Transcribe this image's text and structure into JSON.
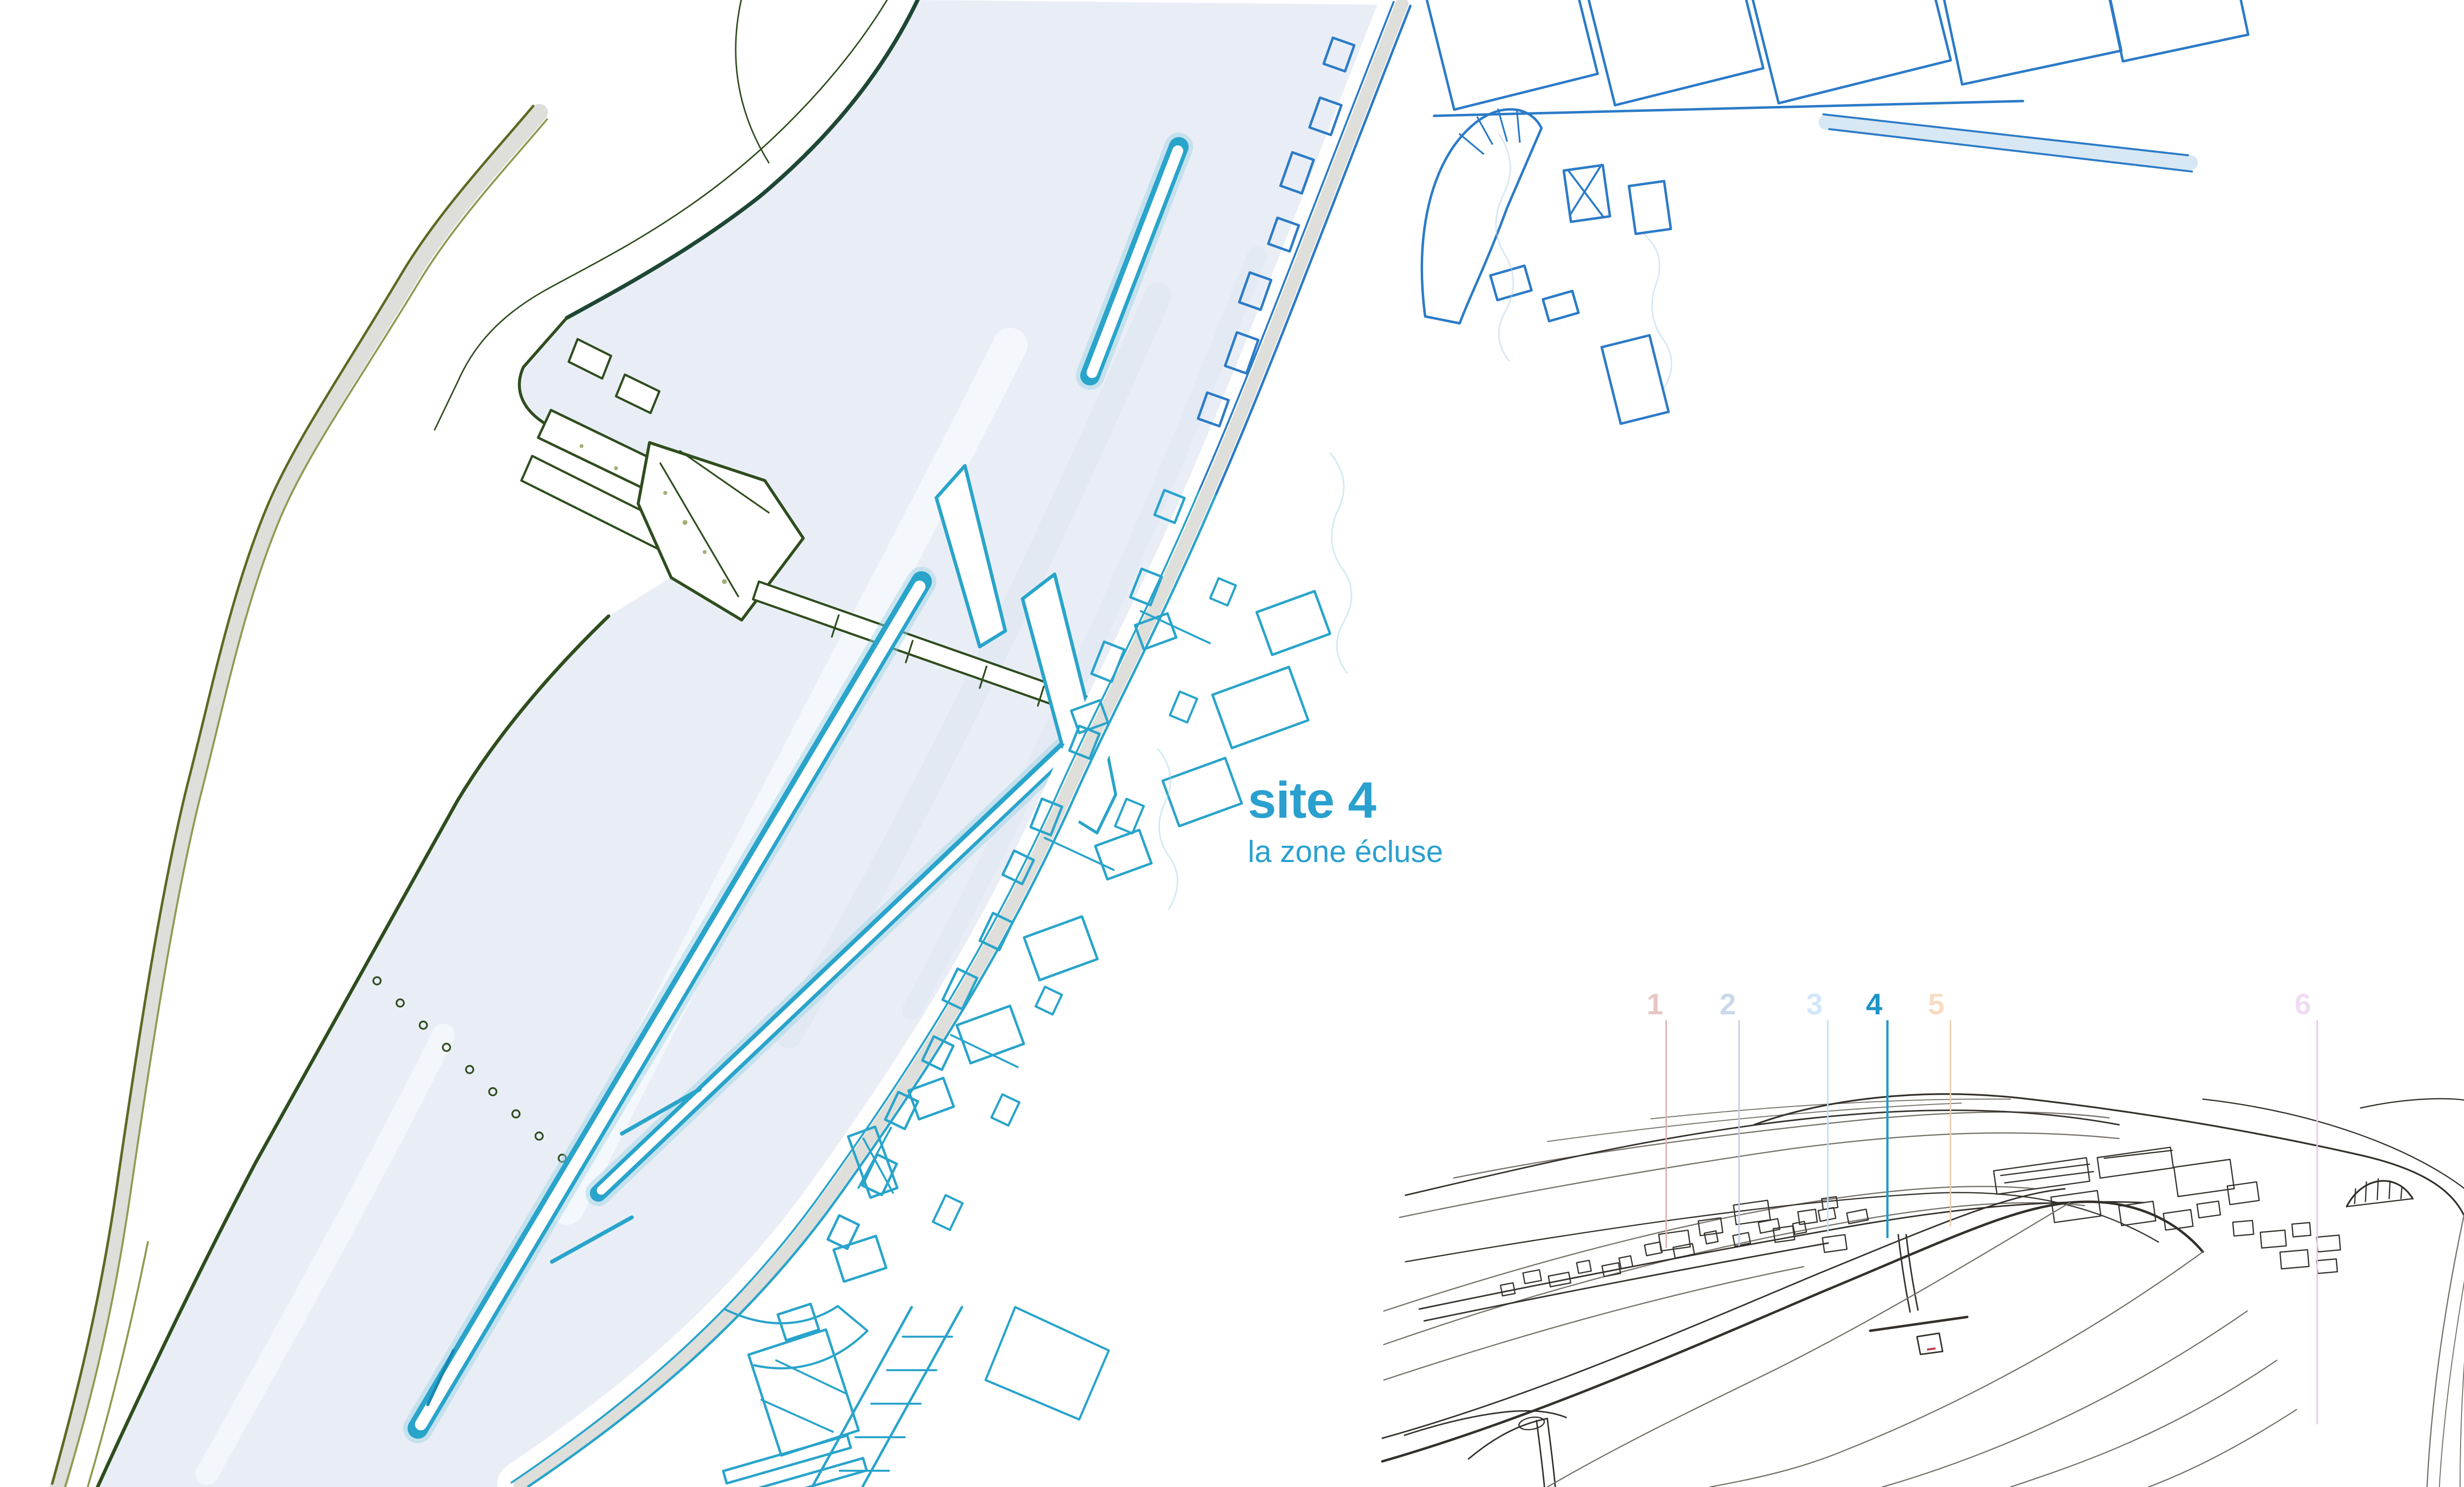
{
  "map_label": {
    "title": "site 4",
    "subtitle": "la zone écluse"
  },
  "theme": {
    "water": "#E9EEF6",
    "waterStreak": "#DDE6F1",
    "coastTeal": "#1E4734",
    "green": "#2F4D1E",
    "olive": "#5A6A22",
    "oliveSoft": "#8F9A52",
    "roadGray": "#DEDEDA",
    "cyan": "#29A4CB",
    "cyanDeep": "#1787B2",
    "cyanSoft": "#9AD1E4",
    "blue": "#2C7BC7",
    "blueSoft": "#AFCFEA",
    "ink": "#34312C",
    "inkSoft": "#76726A",
    "title": "#2AA0CF",
    "red": "#C23B4A"
  },
  "inset_markers": [
    {
      "label": "1",
      "num": "#E8C6C2",
      "line": "#E0AFAC"
    },
    {
      "label": "2",
      "num": "#CBD7EC",
      "line": "#BCCCE6"
    },
    {
      "label": "3",
      "num": "#D2E7F9",
      "line": "#BFDFF4"
    },
    {
      "label": "4",
      "num": "#1C95C7",
      "line": "#1E9AC9"
    },
    {
      "label": "5",
      "num": "#F7DCC2",
      "line": "#EECDAD"
    },
    {
      "label": "6",
      "num": "#F0DBF3",
      "line": "#E9C7EC"
    }
  ]
}
